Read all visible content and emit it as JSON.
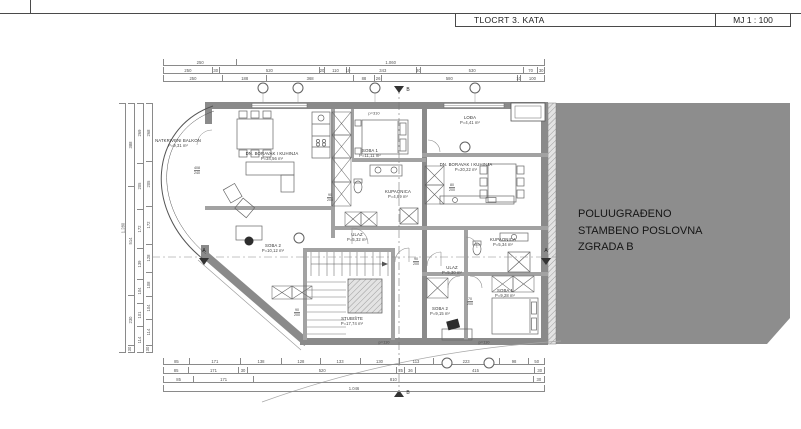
{
  "title_block": {
    "title": "TLOCRT 3. KATA",
    "scale": "MJ 1 : 100"
  },
  "side_note": {
    "lines": [
      "POLUUGRAĐENO",
      "STAMBENO POSLOVNA",
      "ZGRADA B"
    ]
  },
  "rooms": [
    {
      "name": "NATKRIVENI BALKON",
      "area": "P=9,31 m²",
      "x": 178,
      "y": 143
    },
    {
      "name": "DN. BORAVAK I KUHINJA",
      "area": "P=34,56 m²",
      "x": 272,
      "y": 156
    },
    {
      "name": "SOBA 1",
      "area": "P=11,11 m²",
      "x": 370,
      "y": 153
    },
    {
      "name": "KUPAONICA",
      "area": "P=4,89 m²",
      "x": 398,
      "y": 194
    },
    {
      "name": "ULAZ",
      "area": "P=5,32 m²",
      "x": 357,
      "y": 237
    },
    {
      "name": "SOBA 2",
      "area": "P=10,12 m²",
      "x": 273,
      "y": 248
    },
    {
      "name": "STUBIŠTE",
      "area": "P=17,74 m²",
      "x": 352,
      "y": 321
    },
    {
      "name": "LOĐA",
      "area": "P=4,41 m²",
      "x": 470,
      "y": 120
    },
    {
      "name": "DN. BORAVAK I KUHINJA",
      "area": "P=20,22 m²",
      "x": 466,
      "y": 167
    },
    {
      "name": "KUPAONICA",
      "area": "P=5,34 m²",
      "x": 503,
      "y": 242
    },
    {
      "name": "ULAZ",
      "area": "P=5,30 m²",
      "x": 452,
      "y": 270
    },
    {
      "name": "SOBA 1",
      "area": "P=9,28 m²",
      "x": 505,
      "y": 293
    },
    {
      "name": "SOBA 2",
      "area": "P=9,15 m²",
      "x": 440,
      "y": 311
    }
  ],
  "dims": {
    "top": [
      [
        "250",
        "1.060"
      ],
      [
        "250",
        "30",
        "520",
        "20",
        "110",
        "10",
        "343",
        "20",
        "530",
        "70",
        "30"
      ],
      [
        "250",
        "188",
        "368",
        "88",
        "26",
        "580",
        "10",
        "100"
      ]
    ],
    "bottom": [
      [
        "85",
        "171",
        "138",
        "128",
        "133",
        "130",
        "113",
        "223",
        "98",
        "50"
      ],
      [
        "85",
        "171",
        "30",
        "520",
        "25",
        "36",
        "415",
        "30"
      ],
      [
        "85",
        "171",
        "810",
        "30"
      ],
      [
        "1.046"
      ]
    ],
    "left": [
      [
        "1.280"
      ],
      [
        "388",
        "514",
        "230",
        "30"
      ],
      [
        "269",
        "205",
        "172",
        "139",
        "104",
        "101",
        "114"
      ],
      [
        "268",
        "205",
        "172",
        "128",
        "108",
        "104",
        "114",
        "30"
      ]
    ]
  },
  "door_labels": [
    {
      "top": "408",
      "bottom": "240",
      "x": 197,
      "y": 171
    },
    {
      "top": "90",
      "bottom": "205",
      "x": 330,
      "y": 198
    },
    {
      "top": "90",
      "bottom": "200",
      "x": 297,
      "y": 313
    },
    {
      "top": "80",
      "bottom": "200",
      "x": 452,
      "y": 188
    },
    {
      "top": "90",
      "bottom": "200",
      "x": 416,
      "y": 262
    },
    {
      "top": "70",
      "bottom": "200",
      "x": 470,
      "y": 302
    }
  ],
  "misc_labels": [
    {
      "text": "p=310",
      "x": 374,
      "y": 113
    },
    {
      "text": "p=110",
      "x": 384,
      "y": 342
    },
    {
      "text": "p=110",
      "x": 484,
      "y": 342
    }
  ],
  "grid_bubbles": [
    {
      "x": 263,
      "y": 88
    },
    {
      "x": 298,
      "y": 88
    },
    {
      "x": 375,
      "y": 88
    },
    {
      "x": 475,
      "y": 88
    },
    {
      "x": 465,
      "y": 147
    },
    {
      "x": 299,
      "y": 238
    },
    {
      "x": 447,
      "y": 363
    },
    {
      "x": 489,
      "y": 363
    }
  ],
  "section_markers": {
    "horizontal_label": "A",
    "vertical_label": "B"
  },
  "colors": {
    "building_fill": "#8d8d8d",
    "wall_fill": "#8a8a8a",
    "partition_fill": "#a2a2a2",
    "line_color": "#555555",
    "dim_text": "#555555",
    "note_text": "#151515"
  }
}
